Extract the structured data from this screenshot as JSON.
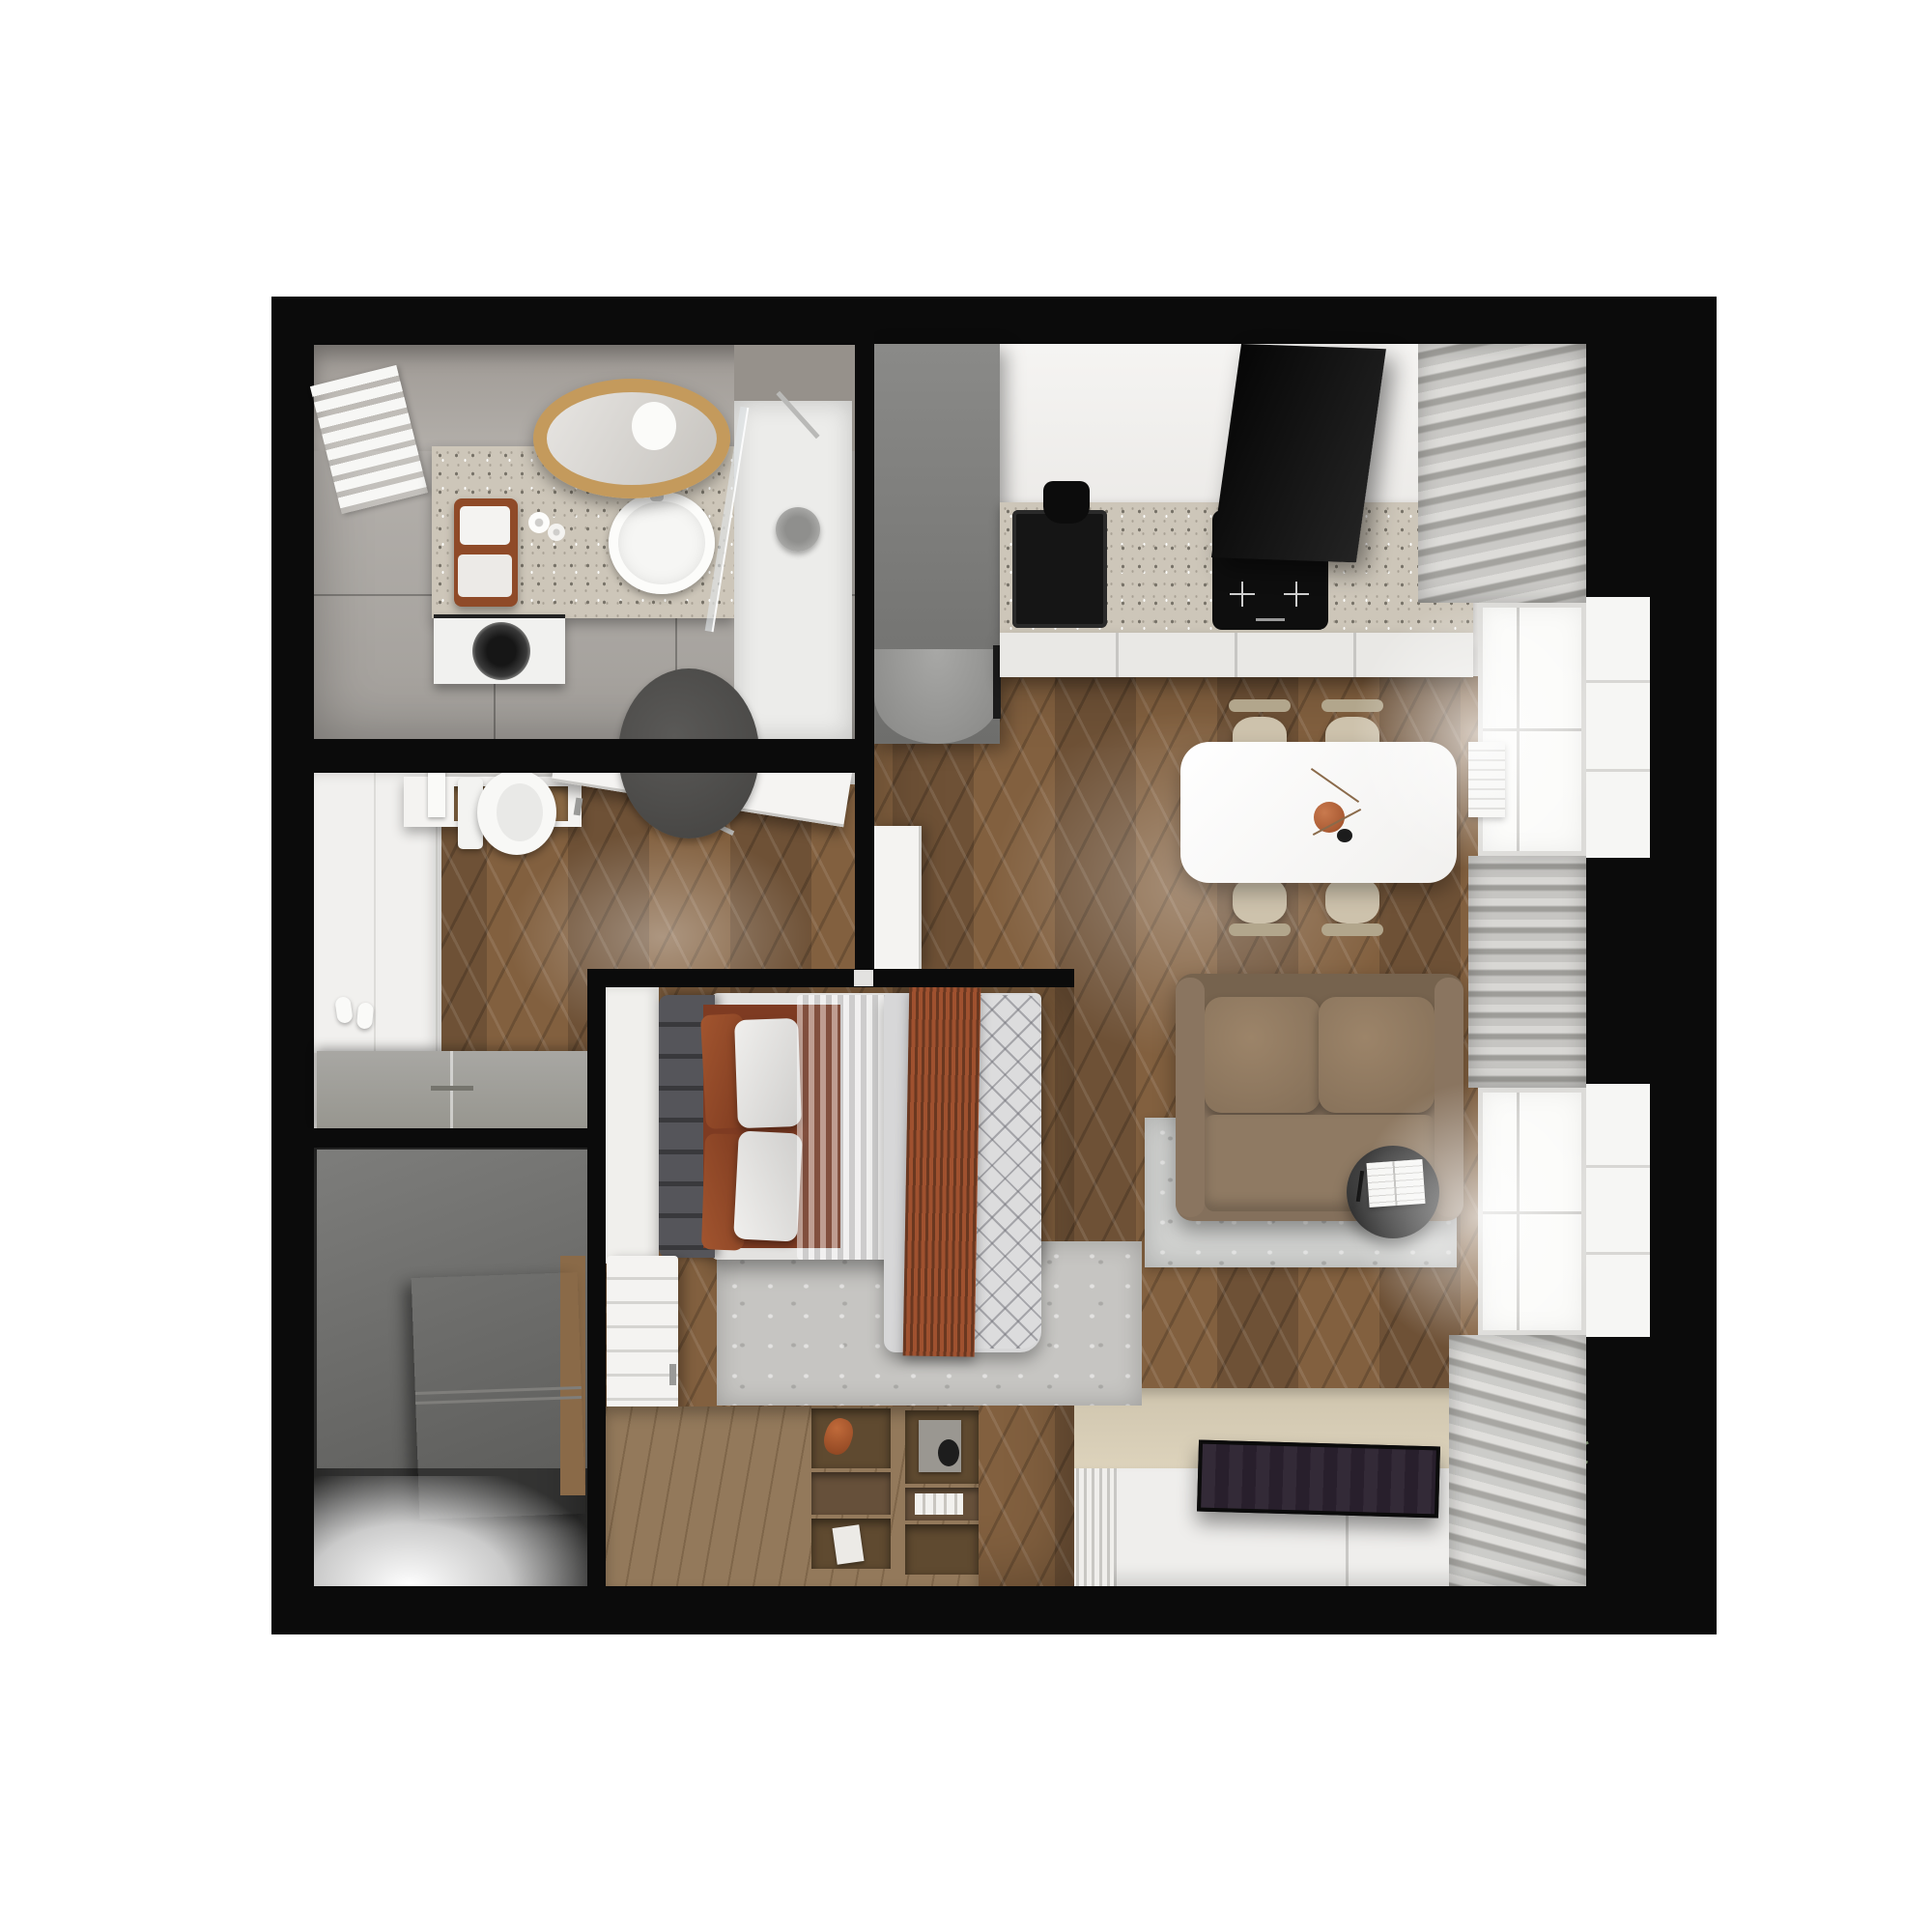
{
  "scene": {
    "type": "apartment-floor-plan",
    "view": "top-down-3d-render",
    "text_visible": false,
    "rooms": [
      {
        "name": "bathroom",
        "furniture": [
          "towel-radiator",
          "vanity-counter",
          "vessel-sink",
          "round-wood-mirror",
          "washing-machine",
          "stool-with-towels",
          "toilet-paper-rolls",
          "walk-in-shower",
          "glass-partition",
          "shower-head",
          "round-dark-rug",
          "toilet",
          "flush-plate"
        ]
      },
      {
        "name": "entry-hallway",
        "furniture": [
          "front-door-open",
          "coat-shelf-with-niche",
          "hanger-rail",
          "built-in-closet",
          "gray-shoe-cabinet",
          "slippers"
        ]
      },
      {
        "name": "wardrobe-room",
        "furniture": [
          "dark-gray-wardrobe",
          "open-wardrobe-door"
        ]
      },
      {
        "name": "bedroom",
        "furniture": [
          "upholstered-headboard",
          "double-bed",
          "rust-pillows",
          "white-pillows",
          "rust-throw-blanket",
          "quilted-duvet",
          "gray-rug",
          "white-slatted-dresser",
          "storage-platform",
          "open-cubby-shelving"
        ]
      },
      {
        "name": "kitchen",
        "furniture": [
          "tall-gray-cabinet",
          "open-white-door",
          "terrazzo-countertop",
          "black-sink",
          "black-faucet",
          "induction-hob",
          "black-extractor-hood",
          "drawer-fronts"
        ]
      },
      {
        "name": "dining-area",
        "furniture": [
          "white-dining-table",
          "terracotta-vase",
          "four-beige-chairs"
        ]
      },
      {
        "name": "living-area",
        "furniture": [
          "brown-two-seat-sofa",
          "round-side-table",
          "open-magazine",
          "light-gray-rug",
          "flat-tv",
          "tv-bench",
          "cream-media-panel",
          "decor-book-and-plate",
          "windows",
          "gray-curtains",
          "roman-shade",
          "white-radiator"
        ]
      }
    ]
  },
  "palette": {
    "wall": "#0b0b0b",
    "wood": "#7a5838",
    "tile": "#b5b1ac",
    "terrazzo": "#cdc6b9",
    "white-furniture": "#f2f1ef",
    "gray-cabinet": "#7b7b79",
    "hall-cabinet": "#9c9b97",
    "wardrobe": "#6b6b69",
    "sofa-brown": "#84705c",
    "chair-beige": "#cdc2ac",
    "rust-accent": "#8e4a2b",
    "terracotta": "#b05c35",
    "duvet-gray": "#d7d7d8",
    "headboard": "#47474a",
    "rug-living": "#d2d3d1",
    "rug-bath": "#504f4d",
    "tv-dark": "#281f2c",
    "media-cream": "#d9cfb8",
    "curtain": "#c6c5c2",
    "greenery": "#7a8a6f"
  }
}
